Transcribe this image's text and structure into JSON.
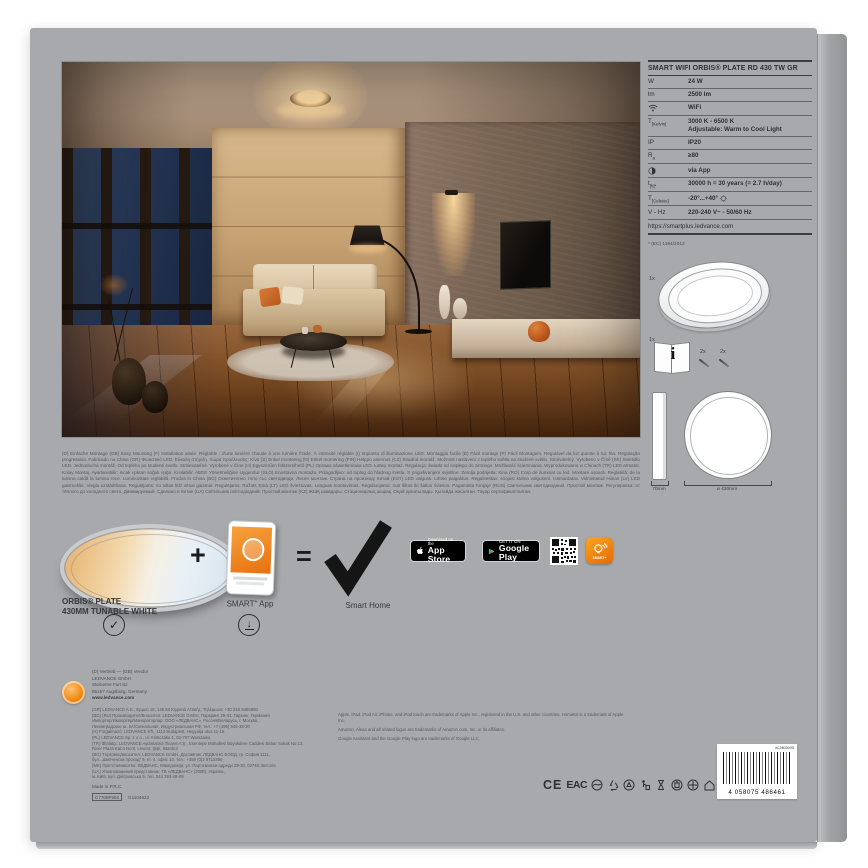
{
  "spec": {
    "title": "SMART WIFI ORBIS® PLATE RD 430 TW GR",
    "rows": [
      {
        "label_main": "W",
        "label_sub": "",
        "value": "24 W"
      },
      {
        "label_main": "lm",
        "label_sub": "",
        "value": "2500 lm"
      },
      {
        "label_main": "",
        "label_sub": "",
        "value": "WiFi"
      },
      {
        "label_main": "T",
        "label_sub": "[Kelvin]",
        "value": "3000 K - 6500 K",
        "value2": "Adjustable: Warm to Cool Light"
      },
      {
        "label_main": "IP",
        "label_sub": "",
        "value": "IP20"
      },
      {
        "label_main": "R",
        "label_sub": "a",
        "value": "≥80"
      },
      {
        "label_main": "",
        "label_sub": "",
        "value": "via App"
      },
      {
        "label_main": "t",
        "label_sub": "[h]*",
        "value": "30000 h = 30 years (= 2.7 h/day)"
      },
      {
        "label_main": "T",
        "label_sub": "[Celsius]",
        "value": "-20°...+40°"
      },
      {
        "label_main": "V - Hz",
        "label_sub": "",
        "value": "220-240 V~ - 50/60 Hz"
      }
    ],
    "url": "https://smartplus.ledvance.com",
    "footnote": "* (EC) 1194/2012"
  },
  "contents": {
    "plate_qty": "1x",
    "manual_qty": "1x",
    "screws_qty": "2x",
    "anchors_qty": "2x",
    "manual_i": "i",
    "depth_label": "70mm",
    "diameter_label": "ø 430mm"
  },
  "lockup": {
    "product_name_line1": "ORBIS® PLATE",
    "product_name_line2": "430MM TUNABLE WHITE",
    "plus": "+",
    "equals": "=",
    "check": "✓",
    "download_arrow": "↓",
    "app_label_main": "SMART",
    "app_label_sup": "+",
    "app_label_rest": " App",
    "result_label": "Smart Home"
  },
  "badges": {
    "app_store_top": "Download on the",
    "app_store_bottom": "App Store",
    "google_play_top": "GET IT ON",
    "google_play_bottom": "Google Play",
    "smart_icon_label": "SMART+"
  },
  "fine_print": "(D) Einfache Montage (GB) Easy Mounting (F) Installation aisée. Réglable : d'une lumière chaude à une lumière froide. À intensité réglable (I) Impianto di illuminazione LED. Montaggio facile (E) Fácil montaje (P) Fácil Montagem. Regulável da luz quente à luz fria. Regulação progressiva. Fabricado na China (GR) Φωτιστικό LED. Εύκολη στήριξη. Χώρα προέλευσης: Κίνα (S) Enkel montering (N) Enkel montering (FIN) Helppo asennus (CZ) Snadná montáž. Možnost nastavení z teplého světla na studené světlo. Stmívatelný. Vyrobeno v Číně (SK) Svietidlo LED. Jednoduchá montáž. Od teplého po studené svetlo. Stmievateľné. Vyrobené v Číne (H) Egyszerűen felszerelhető (PL) Oprawa oświetleniowa LED. Łatwy montaż. Regulacja: światło od ciepłego do zimnego. Możliwość ściemniania. Wyprodukowano w Chinach (TR) LED armatür. Kolay Montaj. Ayarlanabilir: sıcak ışıktan soğuk ışığa. Kısılabilir. AEEE Yönetmeliğine Uygundur (SLO) Enostavna montaža. Prilagodljivo: od toplog do hladnog svetla. S prigušivanjem svjetline. Zemlja podrijetla: Kina (RO) Corp de iluminat cu led. Montare ușoară. Reglabilă: de la lumina caldă la lumina rece. Luminozitate reglabilă. Produs in China (BG) Осветително тяло със светодиоди. Лесен монтаж. Страна на произход: Китай (EST) LED valgusti. Lihtne paigaldus. Reguleeritav: soojast külma valguseni. Hämardatav. Valmistatud Hiinas (LV) LED gaismeklis. Viegla uzstādīšana. Regulējams: no siltas līdz vēsai gaismai. Regulējams. Ražots Ķīnā (LT) LED šviestuvas. Lengvas montavimas. Reguliuojama: nuo šiltos iki šaltos šviesos. Pagaminta Kinijoje (RUS) Светильник светодиодный. Простой монтаж. Регулировка: от тёплого до холодного света. Диммируемый. Сделано в Китае (UA) Світильник світлодіодний. Простий монтаж (KZ) ЖШҚ шамдары. Стационарлық шырақ. Оңай орнатылады. Қытайда жасалған. Тауар сертификатталған.",
  "company": {
    "heading": "(D) Vertrieb — (GB) Vendor",
    "name": "LEDVANCE GmbH",
    "street": "Steinerne Furt 62",
    "city": "86167 Augsburg, Germany",
    "web": "www.ledvance.com",
    "address_lines": [
      "(GR) LEDVANCE A.E., Ερμού 15, 145 64 Κηφισιά Αττικής, Τηλέφωνο: +30 210 9485800",
      "(BG) (RU) Производител/Вносител: LEDVANCE GmbH, Паркринг 29-33, Гархинг, Германия",
      "Импортер/Импортёр/Манораторлар: ООО «ЛЕДВАНС», Россия/Беларусь, г. Москва,",
      "Ленинградское ш. 5А/Сигнальная, Индустриальная РФ, тел.: +7 (495) 545-38-30",
      "(H) Forgalmazó: LEDVANCE Kft., 1112 Budapest, Hegyalja utca 11-15.",
      "(PL) LEDVANCE Sp. z o.o., ul. Klimczaka 1, 02-797 Warszawa",
      "(TR) İthalatçı: LEDVANCE Aydınlatma Ticaret A.Ş., Esentepe Mahallesi Büyükdere Caddesi Bahar Sokak No:13,",
      "River Plaza Kat:4 No:8, Levent, Şişli, İstanbul",
      "(BG) Търговец/вносител: LEDVANCE GmbH, Доставчик: ЛЕДВАНС ЕООД, гр. София 1111,",
      "бул. „Шипченски проход“ 9, ет. 4, офис 10, тел.: +359 (0)2 8713390",
      "(MK) Претставништво: ЛЕДВАНС, Македонија, ул. Партизански одреди 29-30, 02748, Битола",
      "(UA) Уповноважений представник: ТВ «ЛЕДВАНС» (2008), Україна,",
      "м. Київ, вул. Дніпровська 9, тел. 044 393-49-09"
    ],
    "made_in": "Made in P.R.C.",
    "code_boxed": "C7708F902",
    "code_plain": "G1104622"
  },
  "trademarks": {
    "line1": "Apple, iPad, iPod Air, iPhone, and iPod touch are trademarks of Apple Inc., registered in the U.S. and other countries. HomeKit is a trademark of Apple Inc.",
    "line2": "Amazon, Alexa and all related logos are trademarks of Amazon.com, Inc. or its affiliates.",
    "line3": "Google Assistant and the Google Play logo are trademarks of Google LLC."
  },
  "certs": {
    "ce": "CE",
    "eac": "EAC",
    "rohs": "RoHS"
  },
  "barcode": {
    "top_code": "AC08020/05",
    "digits": "4 058075 486461"
  },
  "colors": {
    "box_gray": "#a8a9ac",
    "ledvance_orange": "#f08a12",
    "badge_black": "#000000"
  }
}
